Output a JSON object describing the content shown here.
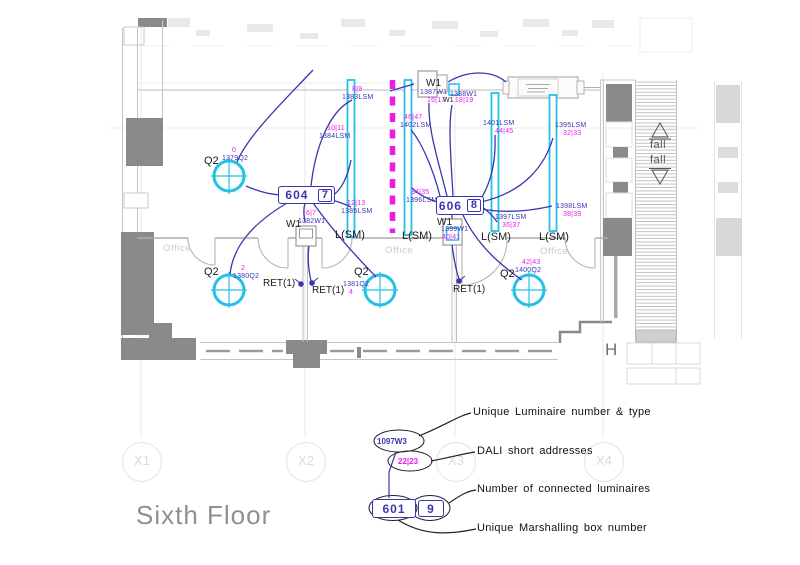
{
  "title": "Sixth Floor",
  "grid": {
    "columns": [
      "X1",
      "X2",
      "X3",
      "X4"
    ]
  },
  "rooms": {
    "office": "Office"
  },
  "annotations": {
    "fall": "fall",
    "stair": "H"
  },
  "symbols": {
    "q2": "Q2",
    "w1": "W1",
    "lsm": "L(SM)",
    "ret": "RET(1)"
  },
  "boxes": [
    {
      "id": "604",
      "count": "7"
    },
    {
      "id": "606",
      "count": "8"
    }
  ],
  "labels": [
    {
      "addr": "0",
      "id": "1379Q2"
    },
    {
      "addr": "8|9",
      "id": "1383LSM"
    },
    {
      "addr": "10|11",
      "id": "1384LSM"
    },
    {
      "addr": "12|13",
      "id": "1385LSM"
    },
    {
      "addr": "6|7",
      "id": "1382W1"
    },
    {
      "addr": "2",
      "id": "1380Q2"
    },
    {
      "addr": "4",
      "id": "1381Q2"
    },
    {
      "addr": "16|17",
      "id": "1387W1"
    },
    {
      "addr": "18|19",
      "id": "1388W1"
    },
    {
      "addr": "46|47",
      "id": "1402LSM"
    },
    {
      "addr": "44|45",
      "id": "1401LSM"
    },
    {
      "addr": "32|33",
      "id": "1395LSM"
    },
    {
      "addr": "34|35",
      "id": "1396LSM"
    },
    {
      "addr": "36|37",
      "id": "1397LSM"
    },
    {
      "addr": "38|39",
      "id": "1398LSM"
    },
    {
      "addr": "40|41",
      "id": "1399W1"
    },
    {
      "addr": "42|43",
      "id": "1400Q2"
    }
  ],
  "legend": {
    "luminaire_ref": "1097W3",
    "dali_ref": "22|23",
    "box_ref": "601",
    "box_count": "9",
    "callouts": [
      "Unique Luminaire number & type",
      "DALI short addresses",
      "Number of connected luminaires",
      "Unique Marshalling box number"
    ]
  },
  "colors": {
    "luminaire_cyan": "#25C0E8",
    "wiring_blue": "#3A36B0",
    "dali_magenta": "#E91CE9",
    "wall_grey": "#8A8A8A"
  }
}
